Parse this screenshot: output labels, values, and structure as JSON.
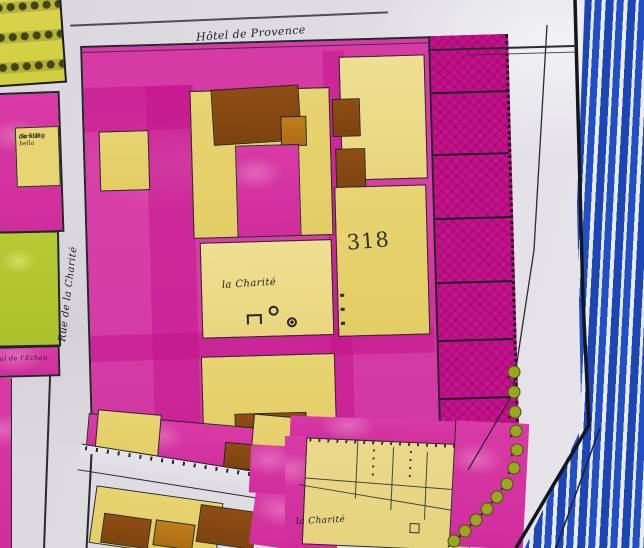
{
  "labels": {
    "street_top": "Hôtel de Provence",
    "street_left": "Rue de la Charité",
    "parcel_number": "318",
    "courtyard": "la Charité",
    "bottom_block": "la Charité",
    "left_parcel_line1": "Giraud",
    "left_parcel_line2": "de Mont bella",
    "left_parcel_line3": "du 5 Trg",
    "left_street_fragment": "al de l'Echau"
  },
  "colors": {
    "paper": "#e0dee3",
    "pink": "#d93aa6",
    "pink_deep": "#c21189",
    "pink_light": "#e77fc5",
    "yellow": "#e7d472",
    "yellow_light": "#efdf92",
    "brown": "#8e4d14",
    "ochre": "#bf7d1a",
    "olive_green": "#b7c934",
    "tree_green": "#9aa81e",
    "garden_yellow": "#d9d44e",
    "garden_tree": "#3f4416",
    "river_blue": "#2150c4",
    "ink": "#24242b"
  }
}
